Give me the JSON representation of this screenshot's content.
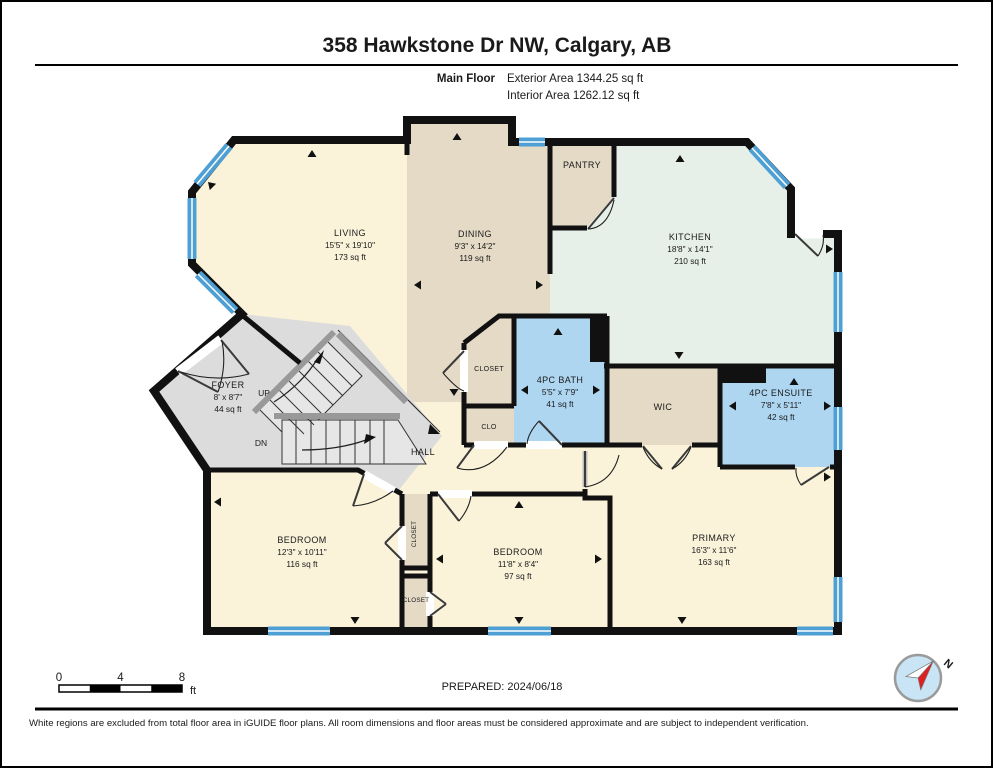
{
  "page": {
    "title": "358 Hawkstone Dr NW, Calgary, AB",
    "floor_label": "Main Floor",
    "exterior_area": "Exterior Area 1344.25 sq ft",
    "interior_area": "Interior Area 1262.12 sq ft",
    "prepared": "PREPARED: 2024/06/18",
    "disclaimer": "White regions are excluded from total floor area in iGUIDE floor plans. All room dimensions and floor areas must be considered approximate and are subject to independent verification.",
    "compass_label": "N"
  },
  "scale_bar": {
    "ticks": [
      "0",
      "4",
      "8"
    ],
    "unit": "ft"
  },
  "rooms": {
    "living": {
      "name": "LIVING",
      "dims": "15'5\" x 19'10\"",
      "area": "173 sq ft"
    },
    "dining": {
      "name": "DINING",
      "dims": "9'3\" x 14'2\"",
      "area": "119 sq ft"
    },
    "kitchen": {
      "name": "KITCHEN",
      "dims": "18'8\" x 14'1\"",
      "area": "210 sq ft"
    },
    "pantry": {
      "name": "PANTRY"
    },
    "foyer": {
      "name": "FOYER",
      "dims": "8' x 8'7\"",
      "area": "44 sq ft"
    },
    "bath": {
      "name": "4PC BATH",
      "dims": "5'5\" x 7'9\"",
      "area": "41 sq ft"
    },
    "ensuite": {
      "name": "4PC ENSUITE",
      "dims": "7'8\" x 5'11\"",
      "area": "42 sq ft"
    },
    "wic": {
      "name": "WIC"
    },
    "closet_hall": {
      "name": "CLOSET"
    },
    "clo": {
      "name": "CLO"
    },
    "hall": {
      "name": "HALL"
    },
    "bedroom1": {
      "name": "BEDROOM",
      "dims": "12'3\" x 10'11\"",
      "area": "116 sq ft"
    },
    "bedroom2": {
      "name": "BEDROOM",
      "dims": "11'8\" x 8'4\"",
      "area": "97 sq ft"
    },
    "primary": {
      "name": "PRIMARY",
      "dims": "16'3\" x 11'6\"",
      "area": "163 sq ft"
    },
    "closet_bed1": {
      "name": "CLOSET"
    },
    "closet_bed2": {
      "name": "CLOSET"
    },
    "stairs_up": "UP",
    "stairs_dn": "DN"
  },
  "colors": {
    "wall": "#111111",
    "window_blue": "#4d9fd4",
    "room_cream": "#faf3da",
    "room_tan": "#e4dac6",
    "room_green": "#e7f0e8",
    "room_blue": "#aed6f1",
    "room_gray": "#dcdcdc",
    "compass_fill": "#c9e4f5",
    "compass_needle": "#e02020"
  }
}
